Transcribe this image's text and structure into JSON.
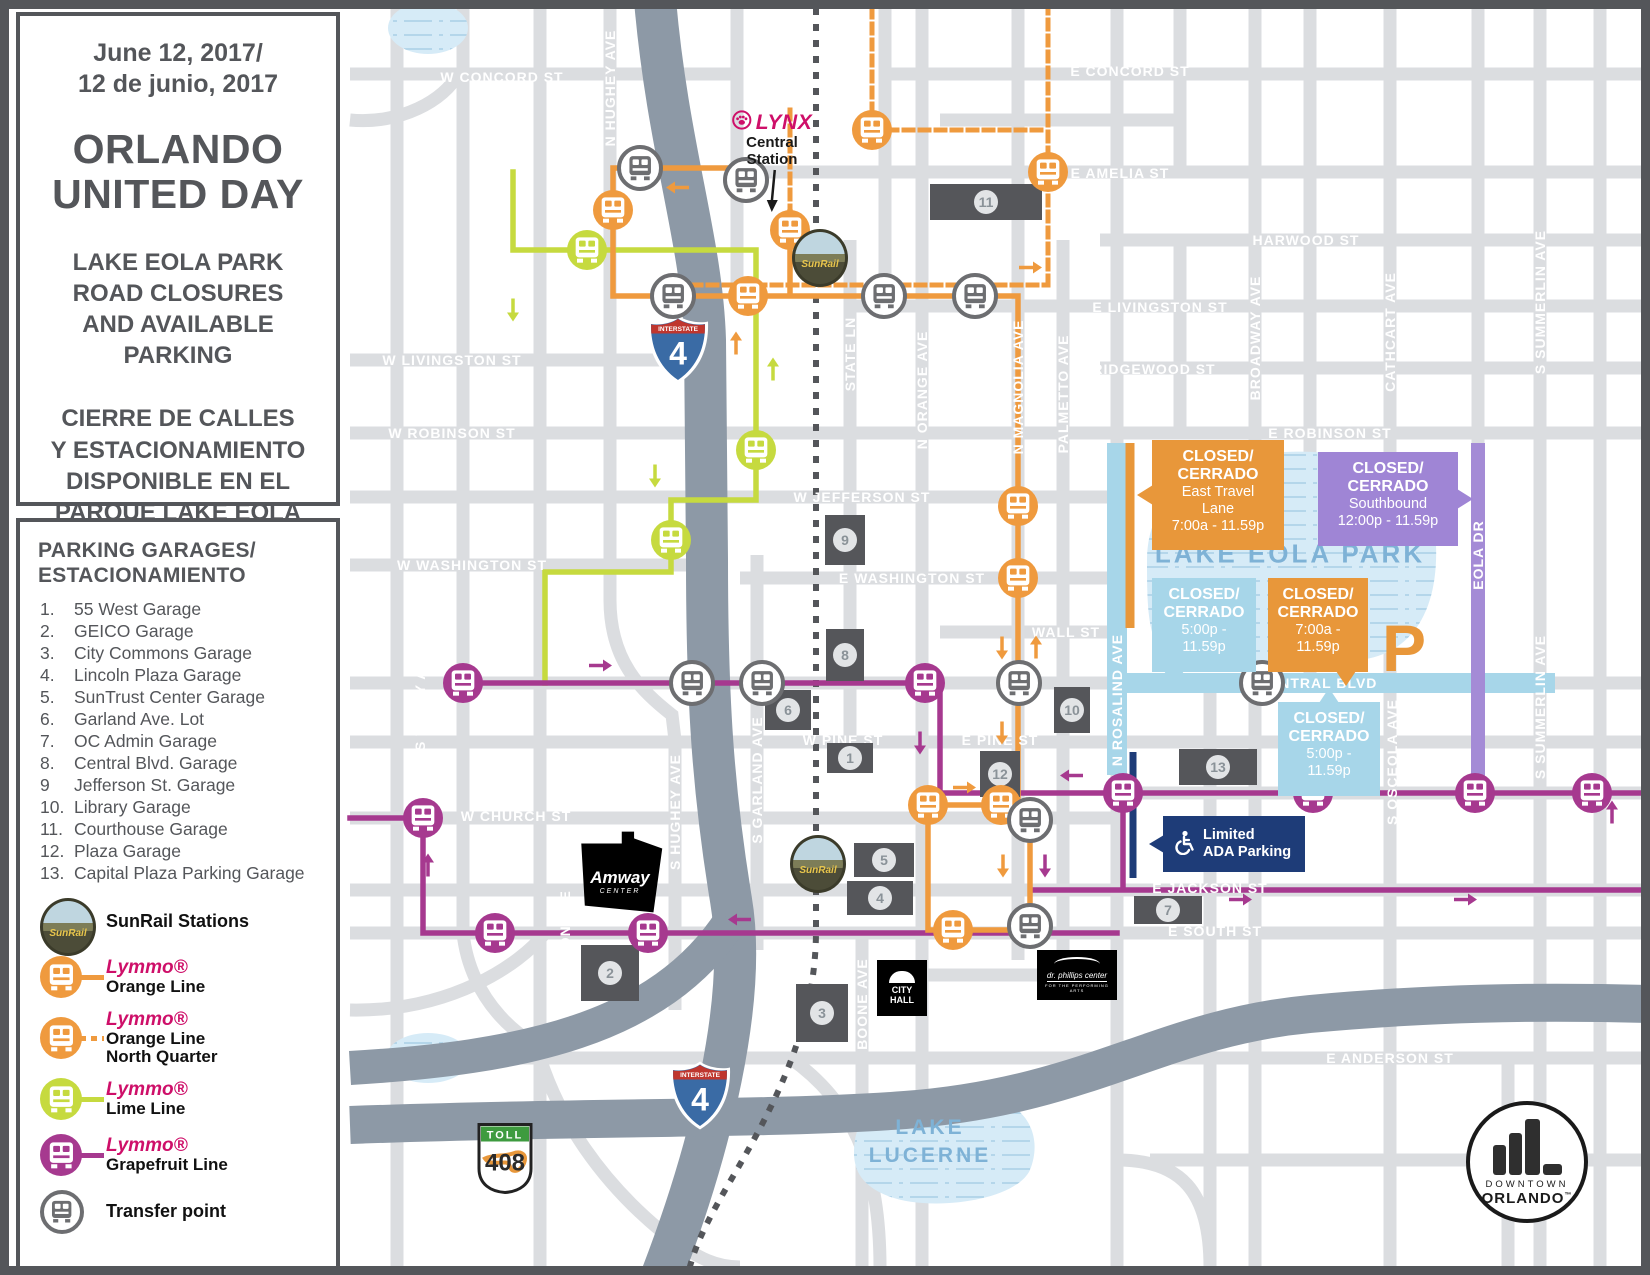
{
  "sidebar": {
    "date_line1": "June 12, 2017/",
    "date_line2": "12 de junio, 2017",
    "title_line1": "ORLANDO",
    "title_line2": "UNITED DAY",
    "subtitle_en": [
      "LAKE EOLA PARK",
      "ROAD CLOSURES",
      "AND AVAILABLE",
      "PARKING"
    ],
    "subtitle_es": [
      "CIERRE DE CALLES",
      "Y ESTACIONAMIENTO",
      "DISPONIBLE  EN EL",
      "PARQUE LAKE EOLA"
    ]
  },
  "parking": {
    "heading": [
      "PARKING GARAGES/",
      "ESTACIONAMIENTO"
    ],
    "items": [
      {
        "num": "1.",
        "name": "55 West Garage"
      },
      {
        "num": "2.",
        "name": "GEICO Garage"
      },
      {
        "num": "3.",
        "name": "City Commons Garage"
      },
      {
        "num": "4.",
        "name": "Lincoln Plaza Garage"
      },
      {
        "num": "5.",
        "name": "SunTrust Center Garage"
      },
      {
        "num": "6.",
        "name": "Garland Ave. Lot"
      },
      {
        "num": "7.",
        "name": "OC Admin Garage"
      },
      {
        "num": "8.",
        "name": "Central Blvd. Garage"
      },
      {
        "num": "9",
        "name": "Jefferson St. Garage"
      },
      {
        "num": "10.",
        "name": "Library Garage"
      },
      {
        "num": "11.",
        "name": "Courthouse Garage"
      },
      {
        "num": "12.",
        "name": "Plaza Garage"
      },
      {
        "num": "13.",
        "name": "Capital Plaza Parking Garage"
      }
    ]
  },
  "legend": {
    "sunrail_label": "SunRail Stations",
    "sunrail_badge": "SunRail",
    "lines": [
      {
        "id": "orange",
        "brand": "Lymmo®",
        "labels": [
          "Orange Line"
        ],
        "dashed": false
      },
      {
        "id": "orange",
        "brand": "Lymmo®",
        "labels": [
          "Orange Line",
          "North Quarter"
        ],
        "dashed": true
      },
      {
        "id": "lime",
        "brand": "Lymmo®",
        "labels": [
          "Lime Line"
        ],
        "dashed": false
      },
      {
        "id": "grapefruit",
        "brand": "Lymmo®",
        "labels": [
          "Grapefruit Line"
        ],
        "dashed": false
      }
    ],
    "transfer_label": "Transfer point"
  },
  "colors": {
    "orange": "#EF9A3E",
    "lime": "#C6DA3F",
    "grapefruit": "#A6398F",
    "transfer": "#6D6E71",
    "closed_blue": "#A7D6E9",
    "closed_purple": "#9F85D5",
    "closed_orange": "#E8973A",
    "navy": "#1E3C78",
    "dark": "#54565A",
    "lynx_pink": "#CE0F69"
  },
  "map": {
    "street_labels": [
      {
        "t": "W CONCORD ST",
        "x": 502,
        "y": 77
      },
      {
        "t": "E CONCORD ST",
        "x": 1130,
        "y": 71
      },
      {
        "t": "N HUGHEY AVE",
        "x": 610,
        "y": 88,
        "v": 1
      },
      {
        "t": "E AMELIA ST",
        "x": 1120,
        "y": 173
      },
      {
        "t": "HARWOOD ST",
        "x": 1306,
        "y": 240
      },
      {
        "t": "E LIVINGSTON ST",
        "x": 1160,
        "y": 307
      },
      {
        "t": "W LIVINGSTON ST",
        "x": 452,
        "y": 360
      },
      {
        "t": "RIDGEWOOD ST",
        "x": 1154,
        "y": 369
      },
      {
        "t": "BROADWAY AVE",
        "x": 1255,
        "y": 338,
        "v": 1
      },
      {
        "t": "CATHCART AVE",
        "x": 1390,
        "y": 332,
        "v": 1
      },
      {
        "t": "S SUMMERLIN AVE",
        "x": 1540,
        "y": 302,
        "v": 1
      },
      {
        "t": "W ROBINSON ST",
        "x": 452,
        "y": 433
      },
      {
        "t": "E ROBINSON ST",
        "x": 1330,
        "y": 433
      },
      {
        "t": "STATE LN",
        "x": 850,
        "y": 354,
        "v": 1
      },
      {
        "t": "N ORANGE AVE",
        "x": 922,
        "y": 390,
        "v": 1
      },
      {
        "t": "N MAGNOLIA AVE",
        "x": 1018,
        "y": 387,
        "v": 1
      },
      {
        "t": "PALMETTO AVE",
        "x": 1063,
        "y": 394,
        "v": 1
      },
      {
        "t": "W JEFFERSON ST",
        "x": 862,
        "y": 497
      },
      {
        "t": "W WASHINGTON ST",
        "x": 472,
        "y": 565
      },
      {
        "t": "E WASHINGTON ST",
        "x": 912,
        "y": 578
      },
      {
        "t": "WALL ST",
        "x": 1066,
        "y": 632
      },
      {
        "t": "E CENTRAL BLVD",
        "x": 1310,
        "y": 683
      },
      {
        "t": "N ROSALIND AVE",
        "x": 1117,
        "y": 700,
        "v": 1
      },
      {
        "t": "EOLA DR",
        "x": 1478,
        "y": 555,
        "v": 1
      },
      {
        "t": "W PINE ST",
        "x": 843,
        "y": 740
      },
      {
        "t": "E PINE ST",
        "x": 1000,
        "y": 740
      },
      {
        "t": "W CHURCH ST",
        "x": 516,
        "y": 816
      },
      {
        "t": "MARIPOSA ST",
        "x": 1468,
        "y": 840
      },
      {
        "t": "S TERRY AVE",
        "x": 420,
        "y": 700,
        "v": 1
      },
      {
        "t": "S DIVISION AVE",
        "x": 565,
        "y": 950,
        "v": 1
      },
      {
        "t": "S HUGHEY AVE",
        "x": 675,
        "y": 812,
        "v": 1
      },
      {
        "t": "S GARLAND AVE",
        "x": 757,
        "y": 780,
        "v": 1
      },
      {
        "t": "BOONE AVE",
        "x": 862,
        "y": 1004,
        "v": 1
      },
      {
        "t": "S OSCEOLA AVE",
        "x": 1392,
        "y": 762,
        "v": 1
      },
      {
        "t": "S SUMMERLIN AVE",
        "x": 1540,
        "y": 707,
        "v": 1
      },
      {
        "t": "E JACKSON ST",
        "x": 1210,
        "y": 888
      },
      {
        "t": "E SOUTH ST",
        "x": 1215,
        "y": 931
      },
      {
        "t": "E ANDERSON ST",
        "x": 1390,
        "y": 1058
      }
    ],
    "water_labels": [
      {
        "t": "LAKE EOLA PARK",
        "x": 1290,
        "y": 554,
        "s": 26
      },
      {
        "t": "LAKE",
        "x": 930,
        "y": 1128,
        "s": 21
      },
      {
        "t": "LUCERNE",
        "x": 930,
        "y": 1156,
        "s": 21
      }
    ],
    "callouts": [
      {
        "color": "closed_orange",
        "x": 1152,
        "y": 440,
        "w": 132,
        "h": 102,
        "tail": "left",
        "bold": [
          "CLOSED/",
          "CERRADO"
        ],
        "rest": [
          "East Travel",
          "Lane",
          "7:00a - 11.59p"
        ]
      },
      {
        "color": "closed_purple",
        "x": 1318,
        "y": 452,
        "w": 140,
        "h": 86,
        "tail": "right",
        "bold": [
          "CLOSED/",
          "CERRADO"
        ],
        "rest": [
          "Southbound",
          "12:00p - 11.59p"
        ]
      },
      {
        "color": "closed_blue",
        "x": 1152,
        "y": 578,
        "w": 104,
        "h": 86,
        "tail": "bottom-left",
        "bold": [
          "CLOSED/",
          "CERRADO"
        ],
        "rest": [
          "5:00p -",
          "11.59p"
        ]
      },
      {
        "color": "closed_orange",
        "x": 1268,
        "y": 578,
        "w": 100,
        "h": 86,
        "tail": "bottom-right",
        "bold": [
          "CLOSED/",
          "CERRADO"
        ],
        "rest": [
          "7:00a -",
          "11.59p"
        ]
      },
      {
        "color": "closed_blue",
        "x": 1278,
        "y": 702,
        "w": 102,
        "h": 86,
        "tail": "top",
        "bold": [
          "CLOSED/",
          "CERRADO"
        ],
        "rest": [
          "5:00p -",
          "11.59p"
        ]
      }
    ],
    "ada": {
      "line1": "Limited",
      "line2": "ADA Parking",
      "x": 1163,
      "y": 816,
      "w": 126,
      "h": 48
    },
    "garages": [
      {
        "n": "1",
        "x": 850,
        "y": 758,
        "w": 46,
        "h": 30
      },
      {
        "n": "2",
        "x": 610,
        "y": 973,
        "w": 58,
        "h": 56
      },
      {
        "n": "3",
        "x": 822,
        "y": 1013,
        "w": 52,
        "h": 58
      },
      {
        "n": "4",
        "x": 880,
        "y": 898,
        "w": 66,
        "h": 34
      },
      {
        "n": "5",
        "x": 884,
        "y": 860,
        "w": 60,
        "h": 34
      },
      {
        "n": "6",
        "x": 788,
        "y": 710,
        "w": 46,
        "h": 40
      },
      {
        "n": "7",
        "x": 1168,
        "y": 910,
        "w": 68,
        "h": 28
      },
      {
        "n": "8",
        "x": 845,
        "y": 655,
        "w": 38,
        "h": 52
      },
      {
        "n": "9",
        "x": 845,
        "y": 540,
        "w": 40,
        "h": 50
      },
      {
        "n": "10",
        "x": 1072,
        "y": 710,
        "w": 36,
        "h": 46
      },
      {
        "n": "11",
        "x": 986,
        "y": 202,
        "w": 112,
        "h": 36
      },
      {
        "n": "12",
        "x": 1000,
        "y": 774,
        "w": 40,
        "h": 46
      },
      {
        "n": "13",
        "x": 1218,
        "y": 767,
        "w": 78,
        "h": 36
      }
    ],
    "stops": [
      {
        "c": "orange",
        "x": 613,
        "y": 210
      },
      {
        "c": "orange",
        "x": 790,
        "y": 230
      },
      {
        "c": "orange",
        "x": 872,
        "y": 130
      },
      {
        "c": "orange",
        "x": 1048,
        "y": 172
      },
      {
        "c": "orange",
        "x": 748,
        "y": 296
      },
      {
        "c": "orange",
        "x": 1018,
        "y": 506
      },
      {
        "c": "orange",
        "x": 1018,
        "y": 578
      },
      {
        "c": "orange",
        "x": 928,
        "y": 805
      },
      {
        "c": "orange",
        "x": 1001,
        "y": 805
      },
      {
        "c": "orange",
        "x": 953,
        "y": 930
      },
      {
        "c": "lime",
        "x": 587,
        "y": 250
      },
      {
        "c": "lime",
        "x": 756,
        "y": 450
      },
      {
        "c": "lime",
        "x": 671,
        "y": 540
      },
      {
        "c": "grapefruit",
        "x": 463,
        "y": 683
      },
      {
        "c": "grapefruit",
        "x": 925,
        "y": 683
      },
      {
        "c": "grapefruit",
        "x": 423,
        "y": 818
      },
      {
        "c": "grapefruit",
        "x": 495,
        "y": 933
      },
      {
        "c": "grapefruit",
        "x": 648,
        "y": 933
      },
      {
        "c": "grapefruit",
        "x": 1123,
        "y": 793
      },
      {
        "c": "grapefruit",
        "x": 1313,
        "y": 793
      },
      {
        "c": "grapefruit",
        "x": 1475,
        "y": 793
      },
      {
        "c": "grapefruit",
        "x": 1592,
        "y": 793
      },
      {
        "c": "transfer",
        "x": 640,
        "y": 168
      },
      {
        "c": "transfer",
        "x": 746,
        "y": 180
      },
      {
        "c": "transfer",
        "x": 673,
        "y": 296
      },
      {
        "c": "transfer",
        "x": 884,
        "y": 296
      },
      {
        "c": "transfer",
        "x": 975,
        "y": 296
      },
      {
        "c": "transfer",
        "x": 692,
        "y": 683
      },
      {
        "c": "transfer",
        "x": 762,
        "y": 683
      },
      {
        "c": "transfer",
        "x": 1019,
        "y": 683
      },
      {
        "c": "transfer",
        "x": 1262,
        "y": 683
      },
      {
        "c": "transfer",
        "x": 1030,
        "y": 820
      },
      {
        "c": "transfer",
        "x": 1030,
        "y": 926
      }
    ],
    "arrows": [
      {
        "c": "lime",
        "d": "down",
        "x": 513,
        "y": 312
      },
      {
        "c": "lime",
        "d": "up",
        "x": 773,
        "y": 372
      },
      {
        "c": "lime",
        "d": "down",
        "x": 655,
        "y": 478
      },
      {
        "c": "orange",
        "d": "left",
        "x": 678,
        "y": 190
      },
      {
        "c": "orange",
        "d": "up",
        "x": 736,
        "y": 346
      },
      {
        "c": "orange",
        "d": "right",
        "x": 1030,
        "y": 270
      },
      {
        "c": "orange",
        "d": "down",
        "x": 1002,
        "y": 650
      },
      {
        "c": "orange",
        "d": "up",
        "x": 1036,
        "y": 650
      },
      {
        "c": "orange",
        "d": "down",
        "x": 1002,
        "y": 735
      },
      {
        "c": "orange",
        "d": "right",
        "x": 964,
        "y": 790
      },
      {
        "c": "orange",
        "d": "down",
        "x": 1003,
        "y": 868
      },
      {
        "c": "grapefruit",
        "d": "down",
        "x": 1045,
        "y": 868
      },
      {
        "c": "grapefruit",
        "d": "right",
        "x": 600,
        "y": 668
      },
      {
        "c": "grapefruit",
        "d": "down",
        "x": 920,
        "y": 745
      },
      {
        "c": "grapefruit",
        "d": "left",
        "x": 1072,
        "y": 778
      },
      {
        "c": "grapefruit",
        "d": "left",
        "x": 1360,
        "y": 778
      },
      {
        "c": "grapefruit",
        "d": "up",
        "x": 1612,
        "y": 815
      },
      {
        "c": "grapefruit",
        "d": "up",
        "x": 428,
        "y": 868
      },
      {
        "c": "grapefruit",
        "d": "right",
        "x": 1240,
        "y": 902
      },
      {
        "c": "grapefruit",
        "d": "right",
        "x": 1465,
        "y": 902
      },
      {
        "c": "grapefruit",
        "d": "left",
        "x": 740,
        "y": 922
      }
    ],
    "lynx": {
      "brand": "LYNX",
      "station_line1": "Central",
      "station_line2": "Station",
      "x": 772,
      "y": 110
    },
    "sunrail_badges": [
      {
        "x": 820,
        "y": 258
      },
      {
        "x": 818,
        "y": 864
      }
    ],
    "shields": {
      "interstate_label": "INTERSTATE",
      "i4_number": "4",
      "toll_label": "TOLL",
      "route_number": "408",
      "i4_positions": [
        {
          "x": 678,
          "y": 352
        },
        {
          "x": 700,
          "y": 1098
        }
      ],
      "toll_position": {
        "x": 505,
        "y": 1160
      }
    },
    "landmarks": {
      "amway": {
        "line1": "Amway",
        "line2": "CENTER",
        "x": 576,
        "y": 830,
        "w": 88,
        "h": 84
      },
      "city_hall": {
        "line1": "CITY",
        "line2": "HALL",
        "x": 877,
        "y": 960,
        "w": 50,
        "h": 56
      },
      "dr_phillips": {
        "line1": "dr. phillips center",
        "line2": "FOR THE PERFORMING ARTS",
        "x": 1037,
        "y": 950,
        "w": 80,
        "h": 50
      },
      "downtown": {
        "line1": "DOWNTOWN",
        "line2": "ORLANDO",
        "tm": "™",
        "x": 1527,
        "y": 1162
      },
      "parking_p": {
        "t": "P",
        "x": 1404,
        "y": 648
      }
    }
  }
}
